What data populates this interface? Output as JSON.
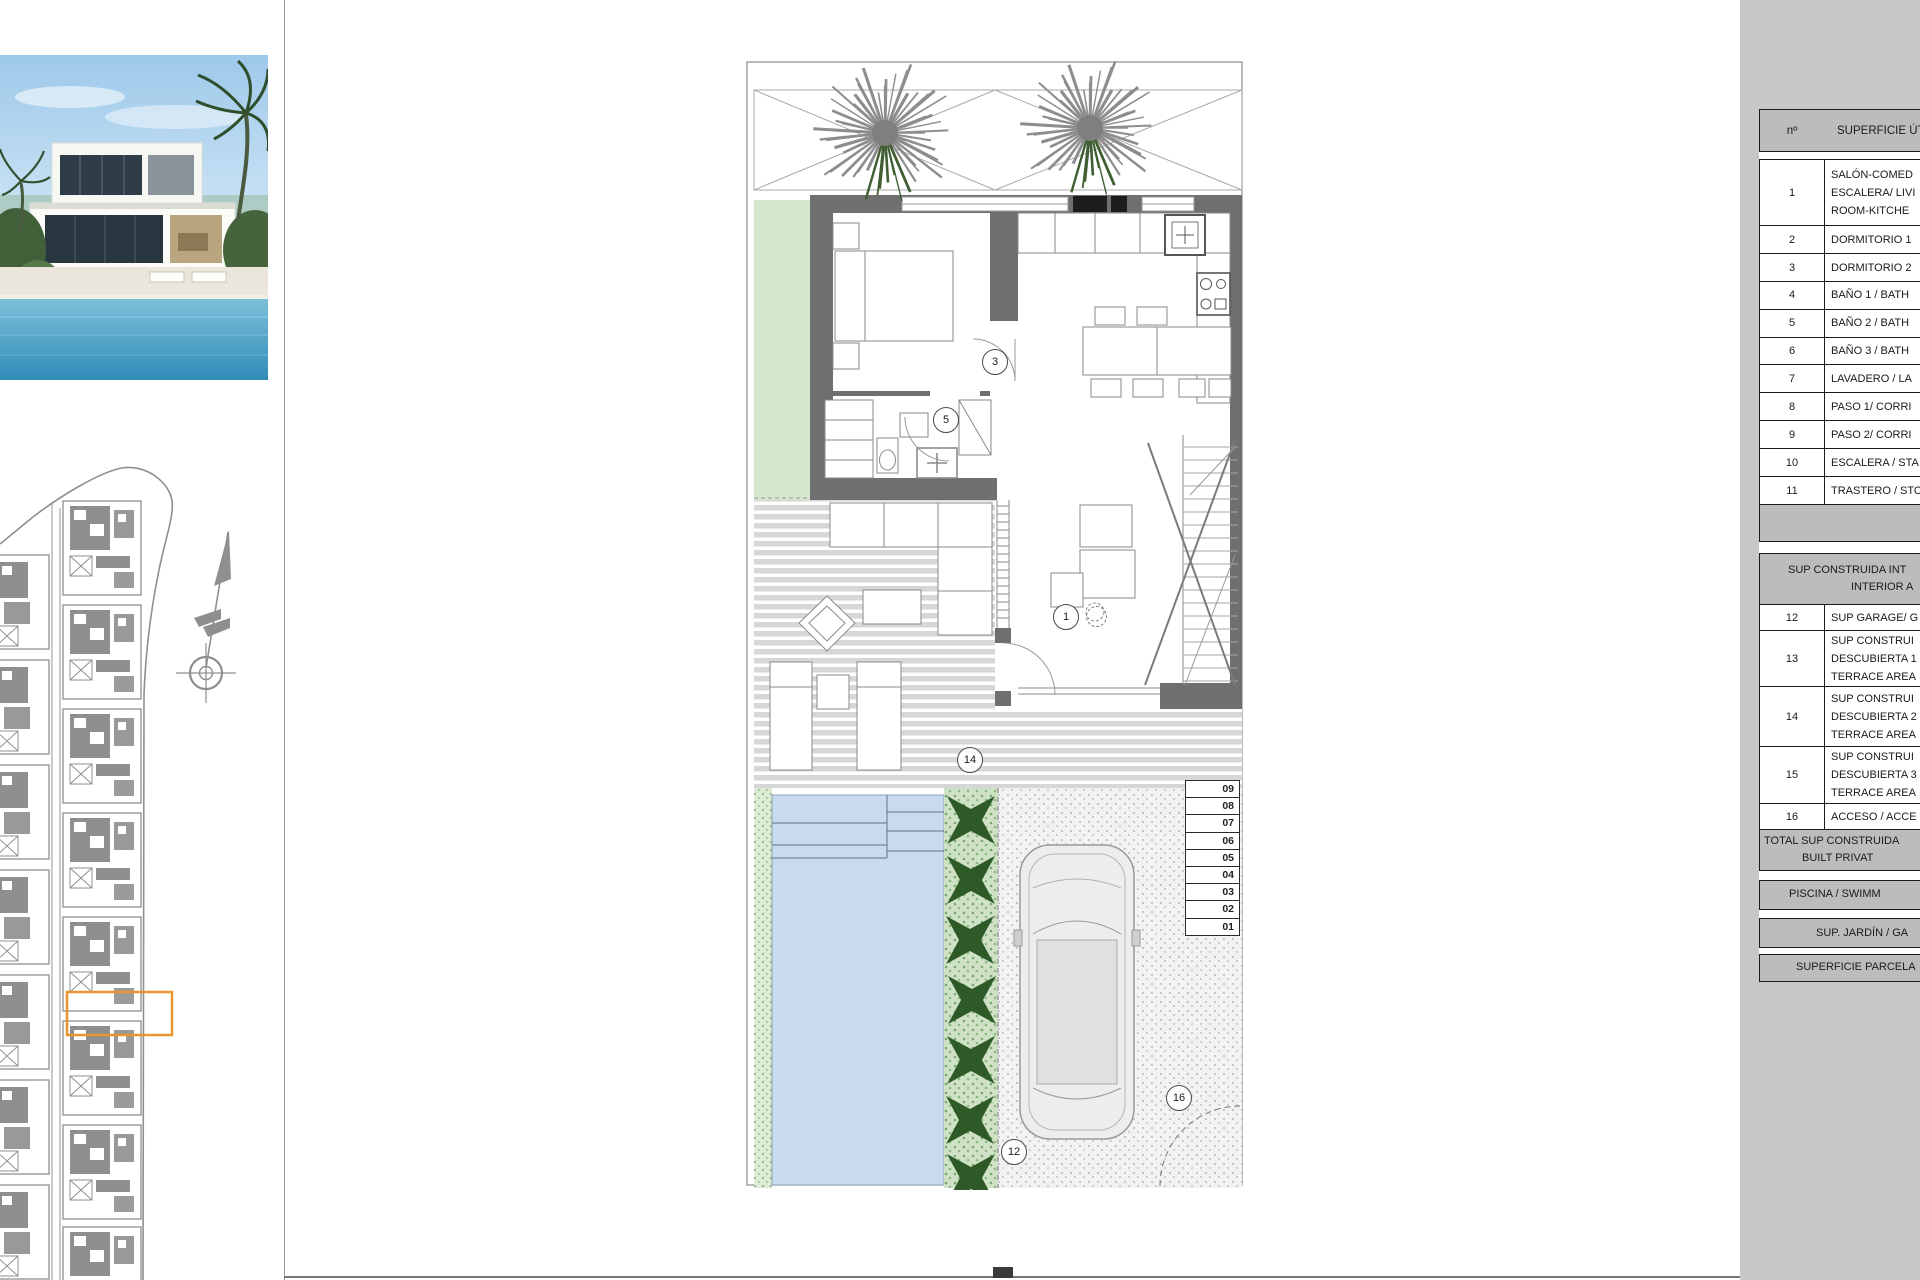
{
  "panel_right": {
    "table1": {
      "header_num": "nº",
      "header_label": "SUPERFICIE ÚTI",
      "rows": [
        {
          "num": "1",
          "lines": [
            "SALÓN-COMED",
            "ESCALERA/ LIVI",
            "ROOM-KITCHE"
          ]
        },
        {
          "num": "2",
          "lines": [
            "DORMITORIO 1"
          ]
        },
        {
          "num": "3",
          "lines": [
            "DORMITORIO 2"
          ]
        },
        {
          "num": "4",
          "lines": [
            "BAÑO 1 / BATH"
          ]
        },
        {
          "num": "5",
          "lines": [
            "BAÑO 2 / BATH"
          ]
        },
        {
          "num": "6",
          "lines": [
            "BAÑO 3 / BATH"
          ]
        },
        {
          "num": "7",
          "lines": [
            "LAVADERO / LA"
          ]
        },
        {
          "num": "8",
          "lines": [
            "PASO 1/ CORRI"
          ]
        },
        {
          "num": "9",
          "lines": [
            "PASO 2/ CORRI"
          ]
        },
        {
          "num": "10",
          "lines": [
            "ESCALERA / STA"
          ]
        },
        {
          "num": "11",
          "lines": [
            "TRASTERO / STO"
          ]
        }
      ],
      "section2_title_lines": [
        "SUP CONSTRUIDA INT",
        "INTERIOR A"
      ],
      "rows2": [
        {
          "num": "12",
          "lines": [
            "SUP GARAGE/ G"
          ]
        },
        {
          "num": "13",
          "lines": [
            "SUP CONSTRUI",
            "DESCUBIERTA 1",
            "TERRACE AREA"
          ]
        },
        {
          "num": "14",
          "lines": [
            "SUP CONSTRUI",
            "DESCUBIERTA 2",
            "TERRACE AREA"
          ]
        },
        {
          "num": "15",
          "lines": [
            "SUP CONSTRUI",
            "DESCUBIERTA 3",
            "TERRACE AREA"
          ]
        },
        {
          "num": "16",
          "lines": [
            "ACCESO / ACCE"
          ]
        }
      ],
      "total_lines": [
        "TOTAL SUP CONSTRUIDA",
        "BUILT PRIVAT"
      ],
      "band_piscina": "PISCINA / SWIMM",
      "band_jardin": "SUP. JARDÍN / GA",
      "band_parcela": "SUPERFICIE PARCELA"
    }
  },
  "plan": {
    "labels": {
      "l1": "1",
      "l3": "3",
      "l5": "5",
      "l12": "12",
      "l14": "14",
      "l16": "16"
    },
    "steps": [
      "09",
      "08",
      "07",
      "06",
      "05",
      "04",
      "03",
      "02",
      "01"
    ],
    "colors": {
      "highlight_orange": "#e8962e",
      "pool_blue": "#c8dbee",
      "garden_green": "#d6e7cf",
      "wall_gray": "#6f6f6f"
    }
  }
}
